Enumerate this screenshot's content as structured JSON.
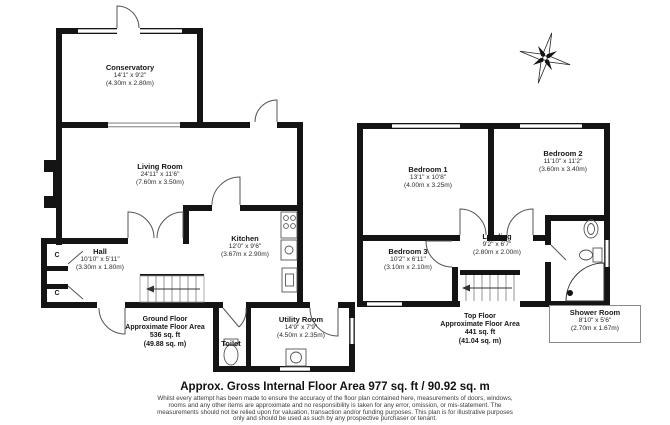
{
  "ground_floor": {
    "conservatory": {
      "name": "Conservatory",
      "size_imperial": "14'1\" x 9'2\"",
      "size_metric": "(4.30m x 2.80m)"
    },
    "living_room": {
      "name": "Living Room",
      "size_imperial": "24'11\" x 11'6\"",
      "size_metric": "(7.60m x 3.50m)"
    },
    "hall": {
      "name": "Hall",
      "size_imperial": "10'10\" x 5'11\"",
      "size_metric": "(3.30m x 1.80m)"
    },
    "kitchen": {
      "name": "Kitchen",
      "size_imperial": "12'0\" x 9'6\"",
      "size_metric": "(3.67m x 2.90m)"
    },
    "utility_room": {
      "name": "Utility Room",
      "size_imperial": "14'9\" x 7'9\"",
      "size_metric": "(4.50m x 2.35m)"
    },
    "toilet": {
      "name": "Toilet"
    },
    "cupboard_label": "C",
    "area": {
      "floor": "Ground Floor",
      "label": "Approximate Floor Area",
      "sqft": "536 sq. ft",
      "sqm": "(49.88 sq. m)"
    }
  },
  "top_floor": {
    "bedroom1": {
      "name": "Bedroom 1",
      "size_imperial": "13'1\" x 10'8\"",
      "size_metric": "(4.00m x 3.25m)"
    },
    "bedroom2": {
      "name": "Bedroom 2",
      "size_imperial": "11'10\" x 11'2\"",
      "size_metric": "(3.60m x 3.40m)"
    },
    "bedroom3": {
      "name": "Bedroom 3",
      "size_imperial": "10'2\" x 6'11\"",
      "size_metric": "(3.10m x 2.10m)"
    },
    "landing": {
      "name": "Landing",
      "size_imperial": "9'2\" x 6'7\"",
      "size_metric": "(2.80m x 2.00m)"
    },
    "shower_room": {
      "name": "Shower Room",
      "size_imperial": "8'10\" x 5'6\"",
      "size_metric": "(2.70m x 1.67m)"
    },
    "area": {
      "floor": "Top Floor",
      "label": "Approximate Floor Area",
      "sqft": "441 sq. ft",
      "sqm": "(41.04 sq. m)"
    }
  },
  "footer": {
    "title": "Approx. Gross Internal Floor Area 977 sq. ft / 90.92 sq. m",
    "disclaimer": [
      "Whilst every attempt has been made to ensure the accuracy of the floor plan contained here, measurements of doors, windows,",
      "rooms and any other items are approximate and no responsibility is taken for any error, omission, or mis-statement. The",
      "measurements should not be relied upon for valuation, transaction and/or funding purposes. This plan is for illustrative purposes",
      "only and should be used as such by any prospective purchaser or tenant."
    ]
  },
  "icons": {
    "compass": "compass-rose"
  },
  "colors": {
    "wall": "#141414",
    "text": "#1c1c1c"
  }
}
